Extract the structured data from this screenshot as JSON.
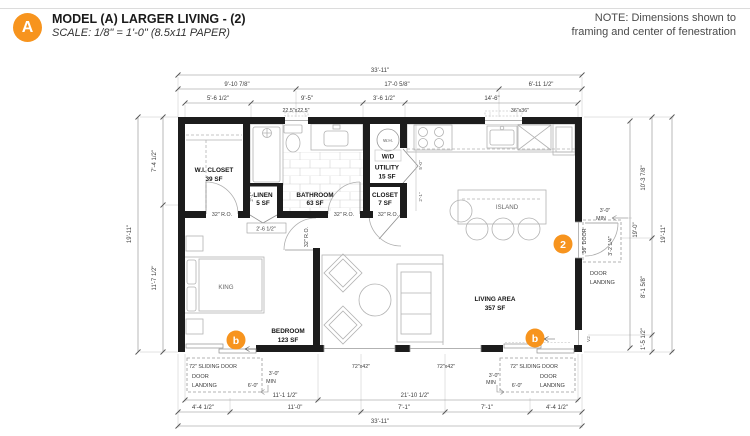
{
  "header": {
    "marker": "A",
    "title": "MODEL (A) LARGER LIVING - (2)",
    "scale_note": "SCALE: 1/8\" = 1'-0\" (8.5x11 PAPER)"
  },
  "note": {
    "line1": "NOTE: Dimensions shown to",
    "line2": "framing and center of fenestration"
  },
  "markers": {
    "entry_door": "2",
    "sliding_door": "b"
  },
  "rooms": {
    "wi_closet": {
      "name": "W.I. CLOSET",
      "area": "39 SF"
    },
    "linen": {
      "name": "LINEN",
      "area": "5 SF"
    },
    "bathroom": {
      "name": "BATHROOM",
      "area": "63 SF"
    },
    "utility": {
      "name": "UTILITY",
      "area": "15 SF"
    },
    "closet": {
      "name": "CLOSET",
      "area": "7 SF"
    },
    "bedroom": {
      "name": "BEDROOM",
      "area": "123 SF"
    },
    "living_area": {
      "name": "LIVING AREA",
      "area": "357 SF"
    },
    "island_label": "ISLAND",
    "bed_label": "KING",
    "water_heater_label": "W.H.",
    "washer_dryer_label": "W/D"
  },
  "dimensions": {
    "top": {
      "overall": "33'-11\"",
      "seg_left": "9'-10 7/8\"",
      "seg_mid": "17'-0 5/8\"",
      "seg_right": "6'-11 1/2\"",
      "sub1": "5'-6 1/2\"",
      "sub2": "9'-5\"",
      "sub3": "3'-6 1/2\"",
      "sub4": "14'-6\"",
      "skylight": "22.5\"x22.5\"",
      "kitchen_window": "36\"x36\""
    },
    "left": {
      "overall": "19'-11\"",
      "upper": "7'-4 1/2\"",
      "lower": "11'-7 1/2\""
    },
    "right": {
      "overall": "19'-11\"",
      "interior": "19'-0\"",
      "upper": "10'-3 7/8\"",
      "mid": "8'-1 5/8\"",
      "lower": "1'-5 1/2\"",
      "min1": "3'-0\"",
      "min2": "MIN",
      "landing_depth": "3'-2 1/4\"",
      "door": "36\" DOOR",
      "landing1": "DOOR",
      "landing2": "LANDING",
      "vent": "V2"
    },
    "bottom": {
      "overall": "33'-11\"",
      "span_left": "11'-1 1/2\"",
      "span_right": "21'-10 1/2\"",
      "seg1": "4'-4 1/2\"",
      "seg2": "11'-0\"",
      "seg3": "7'-1\"",
      "seg4": "7'-1\"",
      "seg5": "4'-4 1/2\"",
      "window": "72\"x42\"",
      "sliding": "72\" SLIDING DOOR",
      "landing1": "DOOR",
      "landing2": "LANDING",
      "clear": "6'-0\"",
      "min1": "3'-0\"",
      "min2": "MIN"
    },
    "interior": {
      "ro32": "32\" R.O.",
      "linen_door": "2'-6 1/2\"",
      "wic_jamb": "2'-1\"",
      "util_h": "5'-0\"",
      "closet_h": "2'-1\""
    }
  }
}
